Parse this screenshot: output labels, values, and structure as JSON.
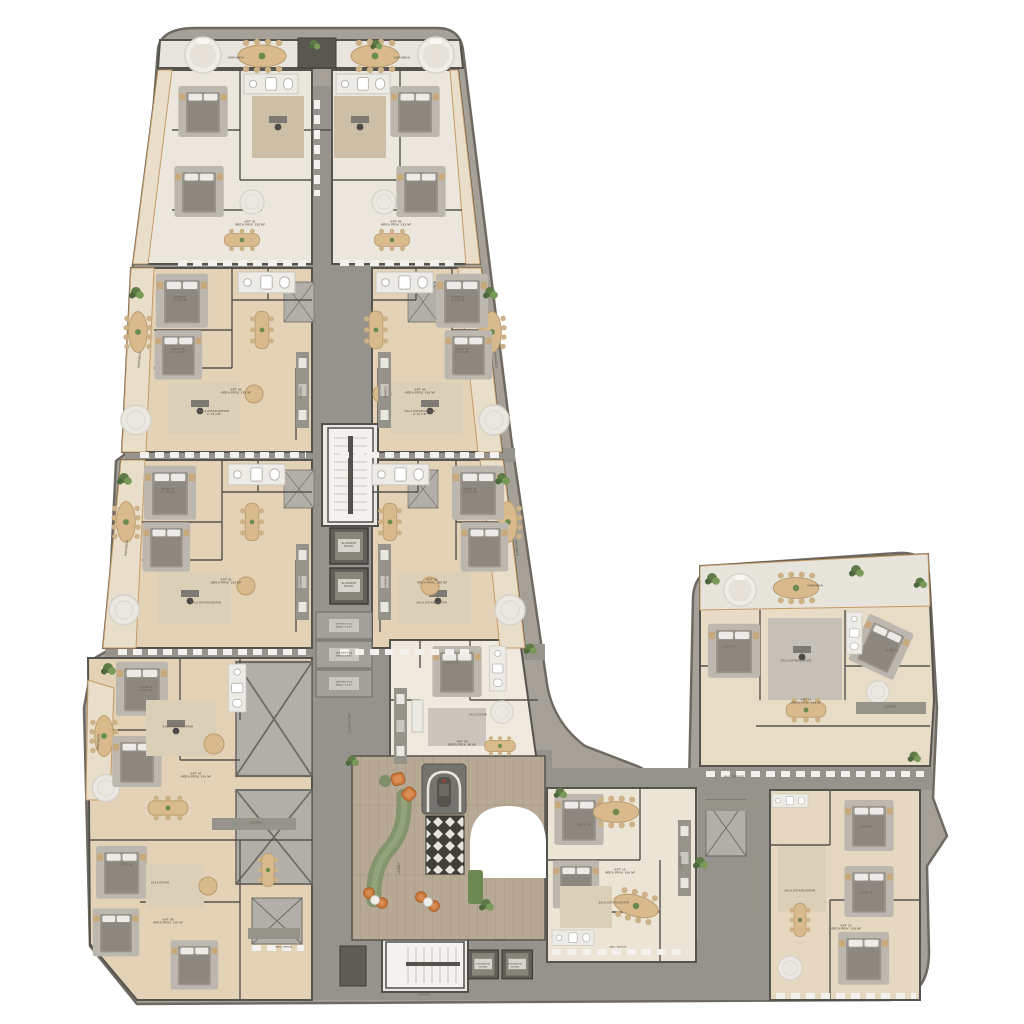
{
  "plan": {
    "type": "residential-floor-plan-rendered",
    "wings": [
      "north-tower",
      "southwest-wing",
      "central-lobby",
      "east-wing"
    ],
    "cores": [
      "stair-core-upper",
      "elevator-pair-upper",
      "storage-stack",
      "stair-core-lobby",
      "elevator-pair-lobby"
    ],
    "amenities": [
      "lobby-lounge",
      "entry-driveway",
      "terraces"
    ]
  },
  "palette": {
    "ground": "#a6a198",
    "ground_edge": "#6f6a61",
    "terrace_floor": "#e7e5de",
    "balcony_tan": "#e9dec9",
    "floor_cream": "#ebe7dd",
    "floor_tan": "#e3d2b6",
    "corridor_grey": "#95938c",
    "wall_dark": "#55534d",
    "core_white": "#f3f2ee",
    "elevator_dark": "#605e59",
    "lobby_wood": "#b7a995",
    "sofa_green": "#84946d",
    "accent_orange": "#cd7a3e",
    "rug_grey": "#bcb8af",
    "table_tan": "#d8ba8c",
    "plant_green": "#5e7a47",
    "rug_pattern_dark": "#413f3a"
  },
  "labels": [
    {
      "t": "VARANDA",
      "x": 236,
      "y": 58,
      "s": 3
    },
    {
      "t": "VARANDA",
      "x": 402,
      "y": 58,
      "s": 3
    },
    {
      "t": "VARANDA",
      "x": 140,
      "y": 360,
      "s": 3,
      "r": -84
    },
    {
      "t": "VARANDA",
      "x": 495,
      "y": 360,
      "s": 3,
      "r": 84
    },
    {
      "t": "VARANDA",
      "x": 127,
      "y": 548,
      "s": 3,
      "r": -84
    },
    {
      "t": "VARANDA",
      "x": 516,
      "y": 548,
      "s": 3,
      "r": 84
    },
    {
      "t": "VARANDA",
      "x": 99,
      "y": 742,
      "s": 3,
      "r": -86
    },
    {
      "t": "VARANDA",
      "x": 815,
      "y": 586,
      "s": 3
    },
    {
      "t": "APT 01\nÁREA PRIV. 132 M²",
      "x": 250,
      "y": 224,
      "s": 3
    },
    {
      "t": "APT 02\nÁREA PRIV. 132 M²",
      "x": 396,
      "y": 224,
      "s": 3
    },
    {
      "t": "APT 03\nÁREA PRIV. 128 M²",
      "x": 236,
      "y": 392,
      "s": 3
    },
    {
      "t": "APT 04\nÁREA PRIV. 128 M²",
      "x": 420,
      "y": 392,
      "s": 3
    },
    {
      "t": "APT 05\nÁREA PRIV. 128 M²",
      "x": 226,
      "y": 582,
      "s": 3
    },
    {
      "t": "APT 06\nÁREA PRIV. 128 M²",
      "x": 432,
      "y": 582,
      "s": 3
    },
    {
      "t": "APT 07\nÁREA PRIV. 140 M²",
      "x": 196,
      "y": 776,
      "s": 3
    },
    {
      "t": "APT 08\nÁREA PRIV. 118 M²",
      "x": 168,
      "y": 922,
      "s": 3
    },
    {
      "t": "APT 09\nÁREA PRIV. 96 M²",
      "x": 462,
      "y": 744,
      "s": 3
    },
    {
      "t": "APT 10\nÁREA PRIV. 150 M²",
      "x": 620,
      "y": 872,
      "s": 3
    },
    {
      "t": "APT 11\nÁREA PRIV. 168 M²",
      "x": 806,
      "y": 702,
      "s": 3
    },
    {
      "t": "APT 12\nÁREA PRIV. 150 M²",
      "x": 846,
      "y": 928,
      "s": 3
    },
    {
      "t": "SUITE 01\nA: 14,5 M²",
      "x": 180,
      "y": 300,
      "s": 2.6
    },
    {
      "t": "SUITE 02\nA: 11,2 M²",
      "x": 178,
      "y": 352,
      "s": 2.6
    },
    {
      "t": "SUITE 01\nA: 14,5 M²",
      "x": 458,
      "y": 300,
      "s": 2.6
    },
    {
      "t": "SUITE 02\nA: 11,2 M²",
      "x": 462,
      "y": 352,
      "s": 2.6
    },
    {
      "t": "SUITE 01\nA: 14,5 M²",
      "x": 168,
      "y": 492,
      "s": 2.6
    },
    {
      "t": "SUITE 01\nA: 14,5 M²",
      "x": 470,
      "y": 492,
      "s": 2.6
    },
    {
      "t": "SUITE 01\nA: 15,0 M²",
      "x": 146,
      "y": 690,
      "s": 2.6
    },
    {
      "t": "SUITE 02",
      "x": 126,
      "y": 866,
      "s": 2.6
    },
    {
      "t": "SUITE 01",
      "x": 452,
      "y": 664,
      "s": 2.6
    },
    {
      "t": "SUITE 01",
      "x": 584,
      "y": 826,
      "s": 2.6
    },
    {
      "t": "SUITE 01",
      "x": 730,
      "y": 648,
      "s": 2.6
    },
    {
      "t": "SUITE 02",
      "x": 892,
      "y": 652,
      "s": 2.6
    },
    {
      "t": "SUITE 01",
      "x": 866,
      "y": 828,
      "s": 2.6
    },
    {
      "t": "SUITE 02",
      "x": 866,
      "y": 894,
      "s": 2.6
    },
    {
      "t": "SALA ESTAR/JANTAR\nA: 32,4 M²",
      "x": 214,
      "y": 414,
      "s": 2.6
    },
    {
      "t": "SALA ESTAR/JANTAR\nA: 32,4 M²",
      "x": 420,
      "y": 414,
      "s": 2.6
    },
    {
      "t": "SALA ESTAR/JANTAR",
      "x": 206,
      "y": 604,
      "s": 2.6
    },
    {
      "t": "SALA ESTAR/JANTAR",
      "x": 432,
      "y": 604,
      "s": 2.6
    },
    {
      "t": "SALA ESTAR/JANTAR",
      "x": 178,
      "y": 728,
      "s": 2.6
    },
    {
      "t": "SALA ESTAR",
      "x": 160,
      "y": 884,
      "s": 2.6
    },
    {
      "t": "SALA ESTAR",
      "x": 478,
      "y": 716,
      "s": 2.6
    },
    {
      "t": "SALA ESTAR/JANTAR",
      "x": 614,
      "y": 904,
      "s": 2.6
    },
    {
      "t": "SALA ESTAR/JANTAR",
      "x": 796,
      "y": 662,
      "s": 2.6
    },
    {
      "t": "SALA ESTAR/JANTAR",
      "x": 800,
      "y": 892,
      "s": 2.6
    },
    {
      "t": "COZINHA",
      "x": 302,
      "y": 392,
      "s": 2.4,
      "r": -90
    },
    {
      "t": "COZINHA",
      "x": 384,
      "y": 392,
      "s": 2.4,
      "r": 90
    },
    {
      "t": "COZINHA",
      "x": 302,
      "y": 582,
      "s": 2.4,
      "r": -90
    },
    {
      "t": "COZINHA",
      "x": 384,
      "y": 582,
      "s": 2.4,
      "r": 90
    },
    {
      "t": "COZINHA",
      "x": 256,
      "y": 824,
      "s": 2.4
    },
    {
      "t": "COZINHA",
      "x": 682,
      "y": 862,
      "s": 2.4,
      "r": -90
    },
    {
      "t": "COZINHA",
      "x": 890,
      "y": 708,
      "s": 2.4
    },
    {
      "t": "ESCADA",
      "x": 350,
      "y": 474,
      "s": 2.8,
      "r": 90
    },
    {
      "t": "ELEVADOR\nSOCIAL",
      "x": 349,
      "y": 546,
      "s": 2.4
    },
    {
      "t": "ELEVADOR\nSOCIAL",
      "x": 349,
      "y": 586,
      "s": 2.4
    },
    {
      "t": "DEPÓSITO 01\nÁREA: 4,8 M²",
      "x": 344,
      "y": 626,
      "s": 2.2
    },
    {
      "t": "DEPÓSITO 02\nÁREA: 4,8 M²",
      "x": 344,
      "y": 655,
      "s": 2.2
    },
    {
      "t": "DEPÓSITO 03\nÁREA: 4,8 M²",
      "x": 344,
      "y": 684,
      "s": 2.2
    },
    {
      "t": "ESCADA",
      "x": 424,
      "y": 966,
      "s": 2.6
    },
    {
      "t": "ELEVADOR\nSOCIAL",
      "x": 483,
      "y": 966,
      "s": 2.2
    },
    {
      "t": "ELEVADOR\nSOCIAL",
      "x": 515,
      "y": 966,
      "s": 2.2
    },
    {
      "t": "LOBBY",
      "x": 400,
      "y": 868,
      "s": 3.2,
      "r": -90
    },
    {
      "t": "ACESSO",
      "x": 424,
      "y": 996,
      "s": 2.6
    },
    {
      "t": "HALL SOCIAL",
      "x": 348,
      "y": 724,
      "s": 2.6,
      "r": 90
    },
    {
      "t": "HALL SERVIÇO",
      "x": 734,
      "y": 778,
      "s": 2.4
    },
    {
      "t": "MED. GERAIS",
      "x": 284,
      "y": 948,
      "s": 2.2
    },
    {
      "t": "MED. GERAIS",
      "x": 618,
      "y": 948,
      "s": 2.2
    }
  ]
}
